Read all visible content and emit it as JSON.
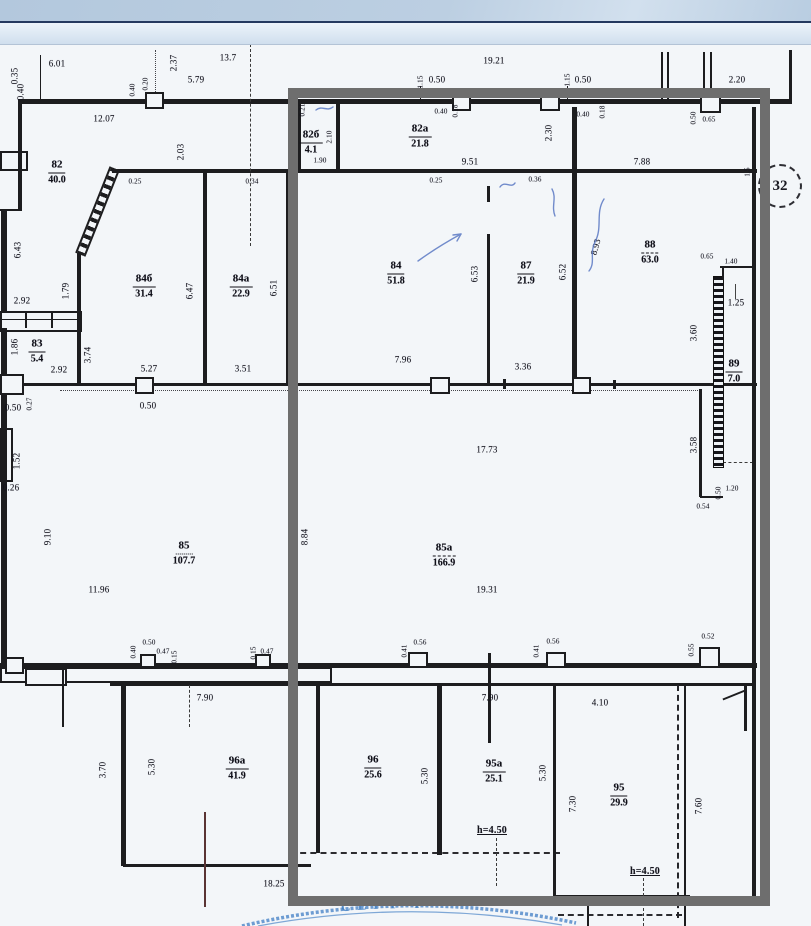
{
  "plan": {
    "paper_color": "#f3f6f9",
    "ink_color": "#1d1d1f",
    "highlight_color": "#6e6e6e",
    "blue_ink_color": "#5b79c4",
    "axis_bubble": "32",
    "stamp_text": "СЕРТ Р",
    "rooms": [
      {
        "num": "82",
        "area": "40.0",
        "x": 57,
        "y": 170
      },
      {
        "num": "82б",
        "area": "4.1",
        "x": 311,
        "y": 140
      },
      {
        "num": "82а",
        "area": "21.8",
        "x": 420,
        "y": 134
      },
      {
        "num": "84б",
        "area": "31.4",
        "x": 144,
        "y": 284
      },
      {
        "num": "84а",
        "area": "22.9",
        "x": 241,
        "y": 284
      },
      {
        "num": "84",
        "area": "51.8",
        "x": 396,
        "y": 271
      },
      {
        "num": "87",
        "area": "21.9",
        "x": 526,
        "y": 271
      },
      {
        "num": "88",
        "area": "63.0",
        "x": 650,
        "y": 250,
        "u": "dashed"
      },
      {
        "num": "89",
        "area": "7.0",
        "x": 734,
        "y": 369
      },
      {
        "num": "83",
        "area": "5.4",
        "x": 37,
        "y": 349
      },
      {
        "num": "85",
        "area": "107.7",
        "x": 184,
        "y": 551,
        "u": "dotted"
      },
      {
        "num": "85а",
        "area": "166.9",
        "x": 444,
        "y": 553,
        "u": "dashed"
      },
      {
        "num": "96а",
        "area": "41.9",
        "x": 237,
        "y": 766
      },
      {
        "num": "96",
        "area": "25.6",
        "x": 373,
        "y": 765
      },
      {
        "num": "95а",
        "area": "25.1",
        "x": 494,
        "y": 769
      },
      {
        "num": "95",
        "area": "29.9",
        "x": 619,
        "y": 793
      }
    ],
    "dims": [
      {
        "t": "6.01",
        "x": 57,
        "y": 64
      },
      {
        "t": "0.35",
        "x": 15,
        "y": 76,
        "r": 90
      },
      {
        "t": "0.40",
        "x": 21,
        "y": 92,
        "r": 90
      },
      {
        "t": "12.07",
        "x": 104,
        "y": 119
      },
      {
        "t": "0.40",
        "x": 133,
        "y": 90,
        "r": 90,
        "s": 1
      },
      {
        "t": "0.20",
        "x": 146,
        "y": 84,
        "r": 90,
        "s": 1
      },
      {
        "t": "2.37",
        "x": 174,
        "y": 63,
        "r": 90
      },
      {
        "t": "5.79",
        "x": 196,
        "y": 80
      },
      {
        "t": "13.7",
        "x": 228,
        "y": 58
      },
      {
        "t": "19.21",
        "x": 494,
        "y": 61
      },
      {
        "t": "1.15",
        "x": 421,
        "y": 82,
        "r": 90,
        "s": 1
      },
      {
        "t": "0.50",
        "x": 437,
        "y": 80
      },
      {
        "t": "1.15",
        "x": 568,
        "y": 80,
        "r": 90,
        "s": 1
      },
      {
        "t": "0.50",
        "x": 583,
        "y": 80
      },
      {
        "t": "2.20",
        "x": 737,
        "y": 80
      },
      {
        "t": "0.21",
        "x": 303,
        "y": 110,
        "r": 90,
        "s": 1
      },
      {
        "t": "2.10",
        "x": 330,
        "y": 137,
        "r": 90,
        "s": 1
      },
      {
        "t": "1.90",
        "x": 320,
        "y": 161,
        "s": 1
      },
      {
        "t": "0.40",
        "x": 441,
        "y": 112,
        "s": 1
      },
      {
        "t": "0.18",
        "x": 456,
        "y": 111,
        "r": 90,
        "s": 1
      },
      {
        "t": "9.51",
        "x": 470,
        "y": 162
      },
      {
        "t": "2.30",
        "x": 549,
        "y": 133,
        "r": 90
      },
      {
        "t": "0.40",
        "x": 583,
        "y": 115,
        "s": 1
      },
      {
        "t": "0.18",
        "x": 603,
        "y": 112,
        "r": 90,
        "s": 1
      },
      {
        "t": "0.50",
        "x": 694,
        "y": 118,
        "r": 90,
        "s": 1
      },
      {
        "t": "0.65",
        "x": 709,
        "y": 120,
        "s": 1
      },
      {
        "t": "7.88",
        "x": 642,
        "y": 162
      },
      {
        "t": "1.5",
        "x": 748,
        "y": 172,
        "r": 90,
        "s": 1
      },
      {
        "t": "2.03",
        "x": 181,
        "y": 152,
        "r": 90
      },
      {
        "t": "0.25",
        "x": 135,
        "y": 182,
        "s": 1
      },
      {
        "t": "0.34",
        "x": 252,
        "y": 182,
        "s": 1
      },
      {
        "t": "0.25",
        "x": 436,
        "y": 181,
        "s": 1
      },
      {
        "t": "0.36",
        "x": 535,
        "y": 180,
        "s": 1
      },
      {
        "t": "6.43",
        "x": 18,
        "y": 250,
        "r": 90
      },
      {
        "t": "1.79",
        "x": 66,
        "y": 291,
        "r": 90
      },
      {
        "t": "2.92",
        "x": 22,
        "y": 301
      },
      {
        "t": "6.47",
        "x": 190,
        "y": 291,
        "r": 90
      },
      {
        "t": "6.51",
        "x": 274,
        "y": 288,
        "r": 90
      },
      {
        "t": "6.53",
        "x": 475,
        "y": 274,
        "r": 90
      },
      {
        "t": "6.52",
        "x": 563,
        "y": 272,
        "r": 90
      },
      {
        "t": "8.93",
        "x": 596,
        "y": 247,
        "r": 75
      },
      {
        "t": "1.86",
        "x": 15,
        "y": 347,
        "r": 90
      },
      {
        "t": "2.92",
        "x": 59,
        "y": 370
      },
      {
        "t": "3.74",
        "x": 88,
        "y": 355,
        "r": 90
      },
      {
        "t": "5.27",
        "x": 149,
        "y": 369
      },
      {
        "t": "3.51",
        "x": 243,
        "y": 369
      },
      {
        "t": "7.96",
        "x": 403,
        "y": 360
      },
      {
        "t": "3.36",
        "x": 523,
        "y": 367
      },
      {
        "t": "0.65",
        "x": 707,
        "y": 257,
        "s": 1
      },
      {
        "t": "1.40",
        "x": 731,
        "y": 262,
        "s": 1
      },
      {
        "t": "1.25",
        "x": 736,
        "y": 303
      },
      {
        "t": "3.60",
        "x": 694,
        "y": 333,
        "r": 90
      },
      {
        "t": "3.58",
        "x": 694,
        "y": 445,
        "r": 90
      },
      {
        "t": "0.50",
        "x": 719,
        "y": 493,
        "r": 90,
        "s": 1
      },
      {
        "t": "1.20",
        "x": 732,
        "y": 489,
        "s": 1
      },
      {
        "t": "0.54",
        "x": 703,
        "y": 507,
        "s": 1
      },
      {
        "t": "0.50",
        "x": 13,
        "y": 408
      },
      {
        "t": "0.27",
        "x": 30,
        "y": 404,
        "r": 90,
        "s": 1
      },
      {
        "t": "1.52",
        "x": 17,
        "y": 461,
        "r": 90
      },
      {
        "t": "0.26",
        "x": 11,
        "y": 488
      },
      {
        "t": "9.10",
        "x": 48,
        "y": 537,
        "r": 90
      },
      {
        "t": "11.96",
        "x": 99,
        "y": 590
      },
      {
        "t": "0.50",
        "x": 148,
        "y": 406
      },
      {
        "t": "8.84",
        "x": 305,
        "y": 537,
        "r": 90
      },
      {
        "t": "17.73",
        "x": 487,
        "y": 450
      },
      {
        "t": "19.31",
        "x": 487,
        "y": 590
      },
      {
        "t": "0.40",
        "x": 134,
        "y": 652,
        "r": 90,
        "s": 1
      },
      {
        "t": "0.50",
        "x": 149,
        "y": 643,
        "s": 1
      },
      {
        "t": "0.47",
        "x": 163,
        "y": 652,
        "s": 1
      },
      {
        "t": "0.15",
        "x": 175,
        "y": 657,
        "r": 90,
        "s": 1
      },
      {
        "t": "0.15",
        "x": 254,
        "y": 653,
        "r": 90,
        "s": 1
      },
      {
        "t": "0.47",
        "x": 267,
        "y": 652,
        "s": 1
      },
      {
        "t": "0.41",
        "x": 405,
        "y": 651,
        "r": 90,
        "s": 1
      },
      {
        "t": "0.56",
        "x": 420,
        "y": 643,
        "s": 1
      },
      {
        "t": "0.41",
        "x": 537,
        "y": 651,
        "r": 90,
        "s": 1
      },
      {
        "t": "0.56",
        "x": 553,
        "y": 642,
        "s": 1
      },
      {
        "t": "0.55",
        "x": 692,
        "y": 650,
        "r": 90,
        "s": 1
      },
      {
        "t": "0.52",
        "x": 708,
        "y": 637,
        "s": 1
      },
      {
        "t": "7.90",
        "x": 205,
        "y": 698
      },
      {
        "t": "7.90",
        "x": 490,
        "y": 698
      },
      {
        "t": "4.10",
        "x": 600,
        "y": 703
      },
      {
        "t": "3.70",
        "x": 103,
        "y": 770,
        "r": 90
      },
      {
        "t": "5.30",
        "x": 152,
        "y": 767,
        "r": 90
      },
      {
        "t": "5.30",
        "x": 425,
        "y": 776,
        "r": 90
      },
      {
        "t": "5.30",
        "x": 543,
        "y": 773,
        "r": 90
      },
      {
        "t": "7.30",
        "x": 573,
        "y": 804,
        "r": 90
      },
      {
        "t": "7.60",
        "x": 699,
        "y": 806,
        "r": 90
      },
      {
        "t": "18.25",
        "x": 274,
        "y": 884
      },
      {
        "t": "h=4.50",
        "x": 492,
        "y": 831,
        "note": 1
      },
      {
        "t": "h=4.50",
        "x": 645,
        "y": 872,
        "note": 1
      }
    ]
  }
}
